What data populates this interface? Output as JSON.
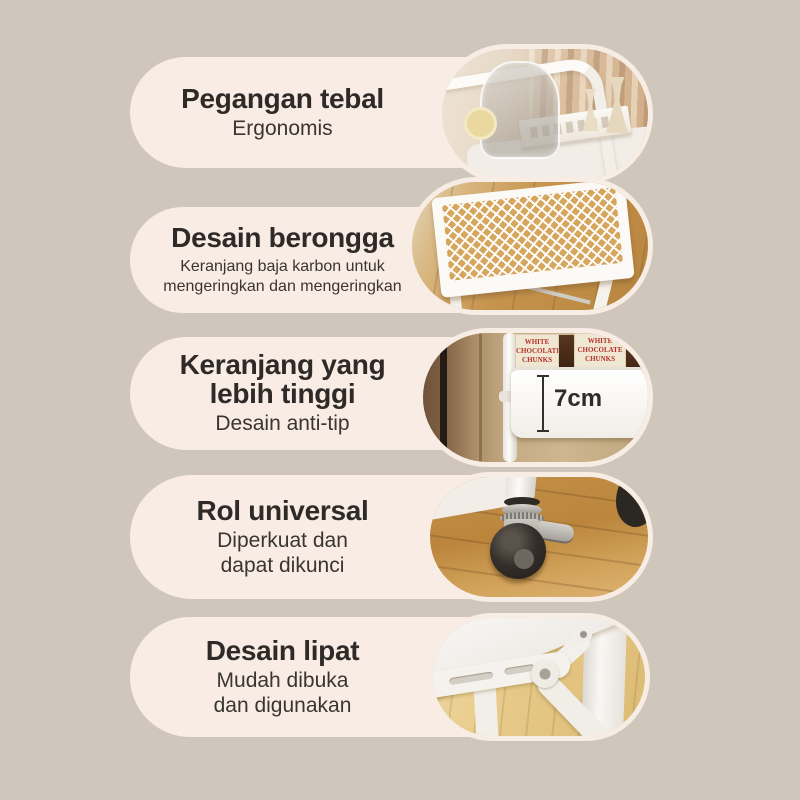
{
  "page": {
    "background_color": "#cfc6bc",
    "card_color": "#f8ece4",
    "title_color": "#2e2a27",
    "subtitle_color": "#3a3531",
    "photo_ring_color": "#f7ede5",
    "package_text_color": "#b5322a"
  },
  "features": [
    {
      "title": "Pegangan tebal",
      "subtitle": "Ergonomis",
      "photo": "handle-with-glassware"
    },
    {
      "title": "Desain berongga",
      "subtitle": "Keranjang baja karbon untuk\nmengeringkan dan mengeringkan",
      "photo": "carbon-steel-mesh-basket"
    },
    {
      "title": "Keranjang yang\nlebih tinggi",
      "subtitle": "Desain anti-tip",
      "photo": "taller-basket-with-packages",
      "dimension_label": "7cm",
      "package_label": "WHITE\nCHOCOLATE\nCHUNKS"
    },
    {
      "title": "Rol universal",
      "subtitle": "Diperkuat dan\ndapat dikunci",
      "photo": "lockable-caster-wheel"
    },
    {
      "title": "Desain lipat",
      "subtitle": "Mudah dibuka\ndan digunakan",
      "photo": "folding-mechanism"
    }
  ]
}
